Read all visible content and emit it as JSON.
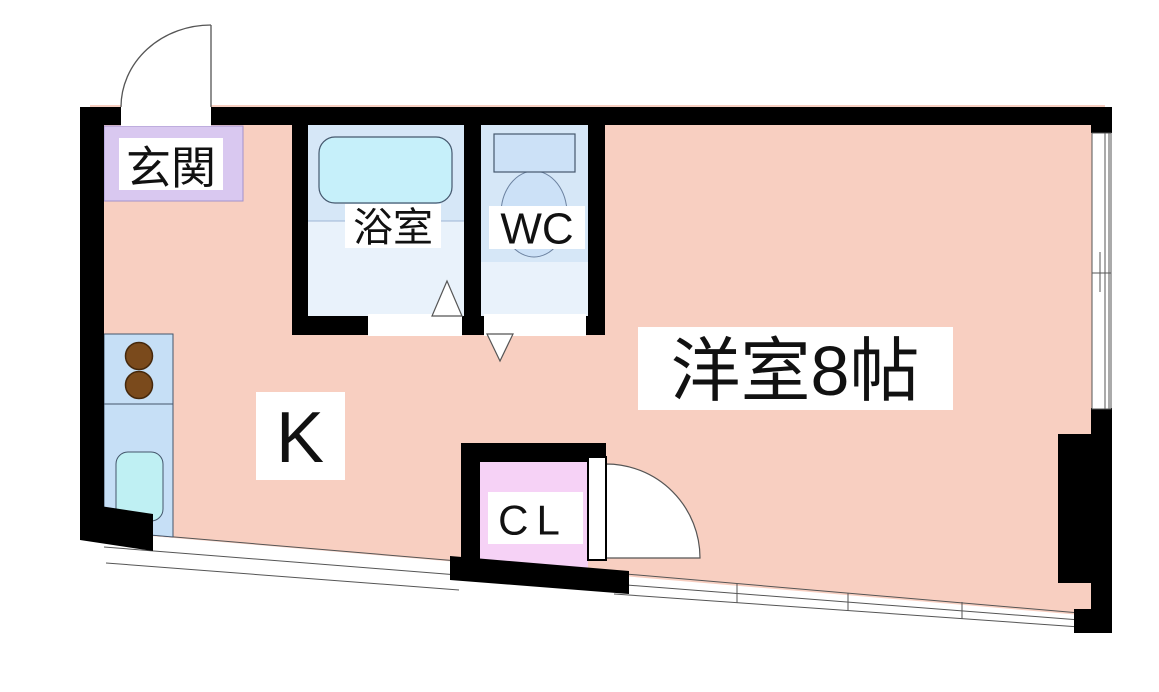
{
  "plan": {
    "type": "apartment-floorplan",
    "labels": {
      "genkan": "玄関",
      "bathroom": "浴室",
      "wc": "WC",
      "kitchen": "K",
      "western_room": "洋室8帖",
      "closet": "CL"
    },
    "colors": {
      "wall": "#000000",
      "floor": "#F8CFC1",
      "genkan": "#D9C8F0",
      "bath_floor": "#D6E7F7",
      "bath_floor_light": "#E9F2FB",
      "bathtub": "#C6F0FA",
      "fixture": "#CCE1F7",
      "counter": "#C6DFF6",
      "sink": "#BFF0F3",
      "burner": "#7A4A1C",
      "closet": "#F6D2F6",
      "label_bg": "#FFFFFF",
      "outline": "#555555"
    }
  }
}
